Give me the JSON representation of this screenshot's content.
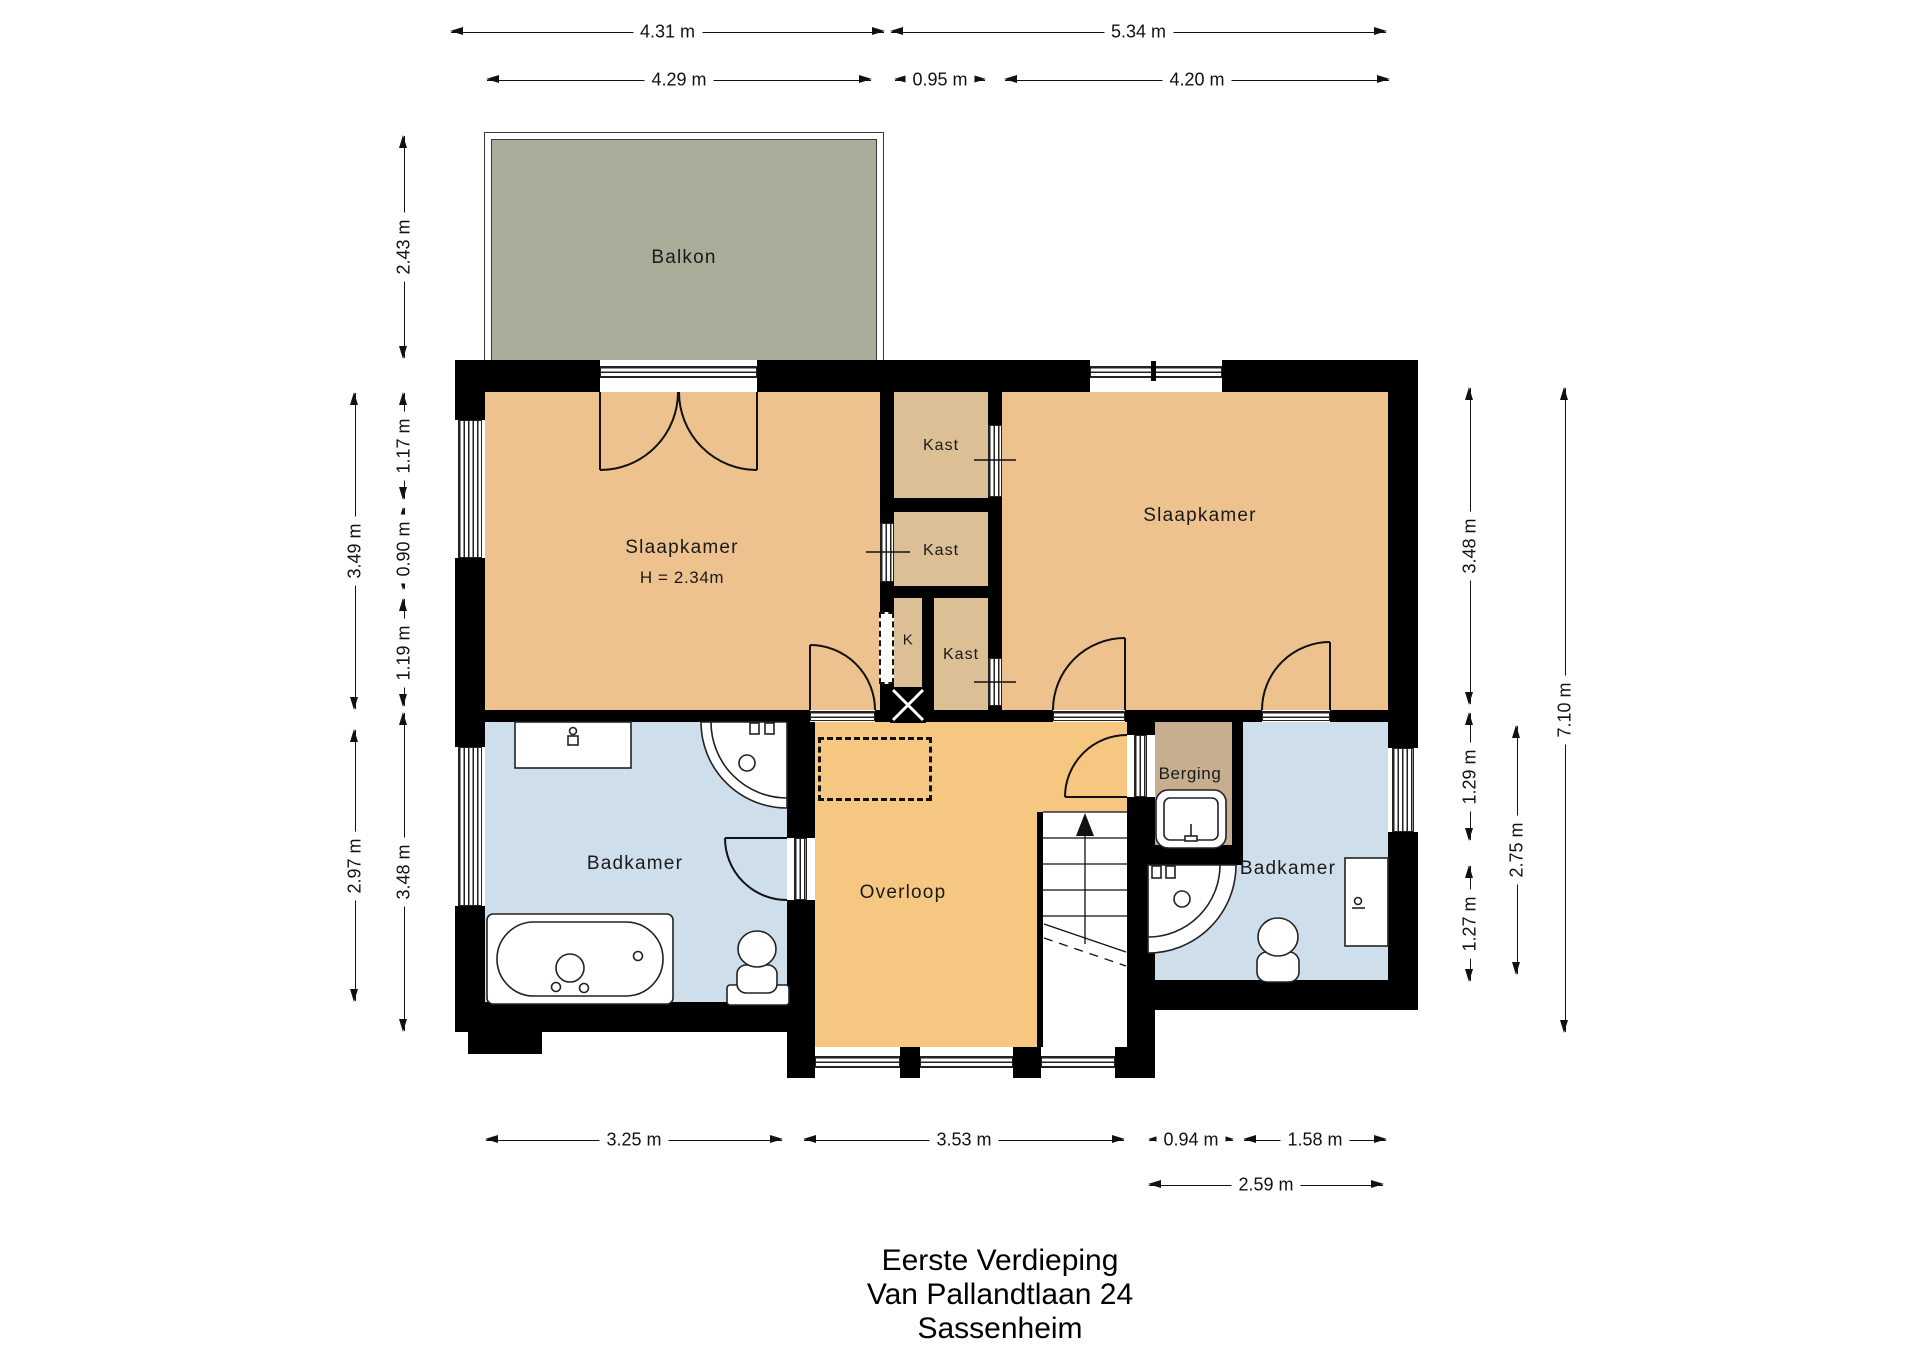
{
  "title": {
    "lines": [
      "Eerste Verdieping",
      "Van Pallandtlaan 24",
      "Sassenheim"
    ]
  },
  "rooms": {
    "balkon": "Balkon",
    "slaapkamer_left": "Slaapkamer",
    "slaapkamer_left_height": "H = 2.34m",
    "kast_top": "Kast",
    "kast_mid": "Kast",
    "k_small": "K",
    "kast_bottom": "Kast",
    "slaapkamer_right": "Slaapkamer",
    "badkamer_left": "Badkamer",
    "overloop": "Overloop",
    "berging": "Berging",
    "badkamer_right": "Badkamer"
  },
  "dimensions": {
    "top1": [
      "4.31 m",
      "5.34 m"
    ],
    "top2": [
      "4.29 m",
      "0.95 m",
      "4.20 m"
    ],
    "left_outer": [
      "3.49 m",
      "2.97 m"
    ],
    "left_inner": [
      "2.43 m",
      "1.17 m",
      "0.90 m",
      "1.19 m",
      "3.48 m"
    ],
    "right_a": [
      "3.48 m",
      "1.29 m",
      "1.27 m"
    ],
    "right_b": [
      "2.75 m"
    ],
    "right_c": [
      "7.10 m"
    ],
    "bottom1": [
      "3.25 m",
      "3.53 m",
      "0.94 m",
      "1.58 m"
    ],
    "bottom2": [
      "2.59 m"
    ]
  },
  "fixtures": {
    "badkamer_left": [
      "counter",
      "corner-shower",
      "bathtub",
      "toilet"
    ],
    "badkamer_right": [
      "corner-shower",
      "toilet",
      "washbasin"
    ],
    "berging": [
      "sink-unit"
    ],
    "overloop": [
      "staircase-up",
      "skylight-dashed"
    ]
  },
  "colors": {
    "wall": "#000000",
    "bedroom_floor": "#edc28e",
    "closet_floor": "#dcbf94",
    "landing_floor": "#f6c780",
    "bathroom_floor": "#cedeeb",
    "storage_floor": "#c6ae8e",
    "balcony_floor": "#a9ac99",
    "line": "#111111"
  }
}
